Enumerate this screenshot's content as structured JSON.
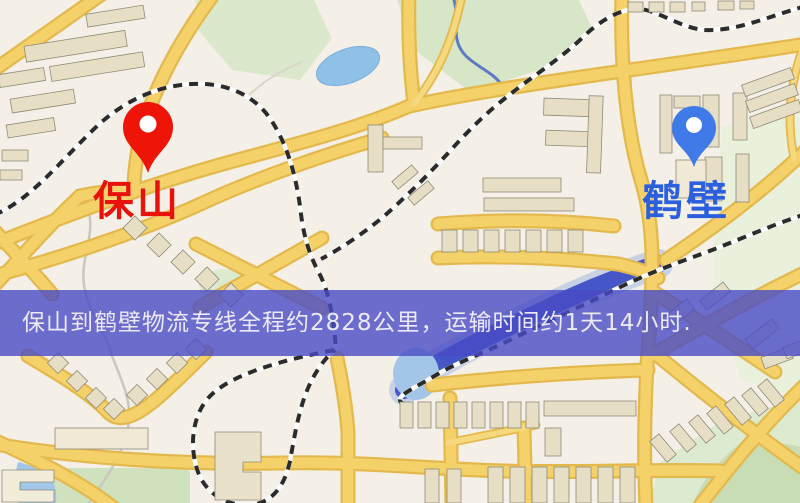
{
  "banner": {
    "text": "保山到鹤壁物流专线全程约2828公里，运输时间约1天14小时.",
    "background_color": "#494bc6",
    "text_color": "#eceaf6"
  },
  "markers": {
    "origin": {
      "label": "保山",
      "pin_color": "#ee1408",
      "label_color": "#e8120a"
    },
    "destination": {
      "label": "鹤壁",
      "pin_color": "#3f7ae8",
      "label_color": "#2b5fdd"
    }
  },
  "map_palette": {
    "background": "#f4f0e7",
    "road_fill": "#f5d169",
    "road_casing": "#e3b94e",
    "park_green": "#d6e6c6",
    "lake_blue": "#8fc0e6",
    "river_blue": "#4557c8",
    "railway_dash": "#2b2b2b",
    "building_beige": "#e7dfc5"
  }
}
